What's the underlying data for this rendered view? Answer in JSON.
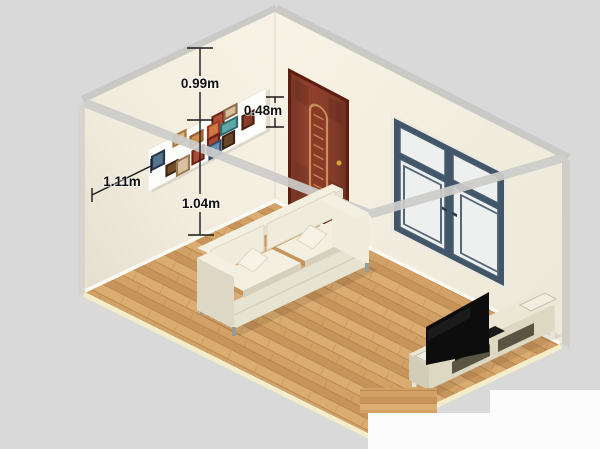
{
  "scene": {
    "type": "3d-room-render",
    "background": "#d9d9d9"
  },
  "annotations": {
    "ceiling_to_pictures": "0.99m",
    "pictures_height": "0.48m",
    "corner_to_pictures": "1.11m",
    "pictures_to_floor": "1.04m"
  },
  "colors": {
    "background": "#d9d9d9",
    "wall_band": "#c9c9c6",
    "wall_end_left": "#d6d4cc",
    "wall_end_right": "#cfcdc5",
    "corner_line": "#e3dccb",
    "stripe": "#cdcdca",
    "baseboard": "#fafaf5",
    "dim_line": "#1a1a1a",
    "dim_text": "#111111",
    "patch_white": "#fcfcfc"
  },
  "floor": {
    "wood": "#cf9d62",
    "plank_light": "#dcae74",
    "plank_mid": "#d2a166",
    "plank_dark": "#c6935a",
    "seam": "#b5834a",
    "border": "#f3edca"
  },
  "objects": {
    "door": {
      "label": "wooden door",
      "leaf": "#91412d",
      "frame": "#5e1d10",
      "accent": "#c98f5c",
      "knob": "#d9a43c"
    },
    "window": {
      "label": "double window",
      "frame": "#42566a",
      "pane": "#edf0ef",
      "reveal": "#eceadf",
      "handle": "#2e3d4c"
    },
    "sofa": {
      "label": "cream three-seat sofa",
      "body": "#f0ecdc",
      "top": "#f3f0e1",
      "shade": "#ddd8c6",
      "front": "#e7e3d1",
      "dark": "#d5d0bc",
      "pillow": "#f6f3e6",
      "leg": "#9a9a96"
    },
    "tv": {
      "label": "flat-screen tv",
      "screen": "#0d0d0d",
      "base": "#191919"
    },
    "tv_stand": {
      "label": "tv console",
      "top": "#ebe7d4",
      "front": "#ddd8c2",
      "end": "#d2cdb8",
      "opening": "#5b5443",
      "leg": "#e8e4d1",
      "tray": "#f1eee0"
    },
    "picture_wall": {
      "label": "gallery panel",
      "panel": "#fdfdfb",
      "frames": [
        {
          "x": 5.5,
          "y": -20,
          "w": 11,
          "h": 14,
          "frame": "#6e2014",
          "art": "#b05038"
        },
        {
          "x": 17.5,
          "y": -20.5,
          "w": 12,
          "h": 9,
          "frame": "#8a6a48",
          "art": "#d9c09a"
        },
        {
          "x": 35.5,
          "y": -5.2,
          "w": 11,
          "h": 13,
          "frame": "#4a1f12",
          "art": "#8a3b28"
        },
        {
          "x": 1,
          "y": -12.6,
          "w": 11,
          "h": 12,
          "frame": "#9c3a20",
          "art": "#d07848"
        },
        {
          "x": 14,
          "y": -7.5,
          "w": 16,
          "h": 10,
          "frame": "#2f6a6e",
          "art": "#5ea8a8"
        },
        {
          "x": -33.5,
          "y": -21,
          "w": 12,
          "h": 10,
          "frame": "#a8743c",
          "art": "#dcb684"
        },
        {
          "x": -16.5,
          "y": -11.9,
          "w": 12,
          "h": 10,
          "frame": "#9a5a28",
          "art": "#cd8f4e"
        },
        {
          "x": 1,
          "y": 0.4,
          "w": 11,
          "h": 13,
          "frame": "#6e2014",
          "art": "#a84832"
        },
        {
          "x": 16,
          "y": 5.2,
          "w": 11,
          "h": 12,
          "frame": "#3c2414",
          "art": "#6b4626"
        },
        {
          "x": 2.5,
          "y": 7.5,
          "w": 11,
          "h": 13,
          "frame": "#2f4a68",
          "art": "#6a8fb4"
        },
        {
          "x": -14.5,
          "y": 3.8,
          "w": 11,
          "h": 13,
          "frame": "#6e2014",
          "art": "#ab4c36"
        },
        {
          "x": -55,
          "y": -11.8,
          "w": 12,
          "h": 13,
          "frame": "#26384a",
          "art": "#54748e"
        },
        {
          "x": -40.5,
          "y": 4.8,
          "w": 11,
          "h": 10,
          "frame": "#3c2414",
          "art": "#704e2a"
        },
        {
          "x": -30,
          "y": 6,
          "w": 12,
          "h": 14,
          "frame": "#9c7850",
          "art": "#d9c2a4"
        }
      ]
    }
  }
}
